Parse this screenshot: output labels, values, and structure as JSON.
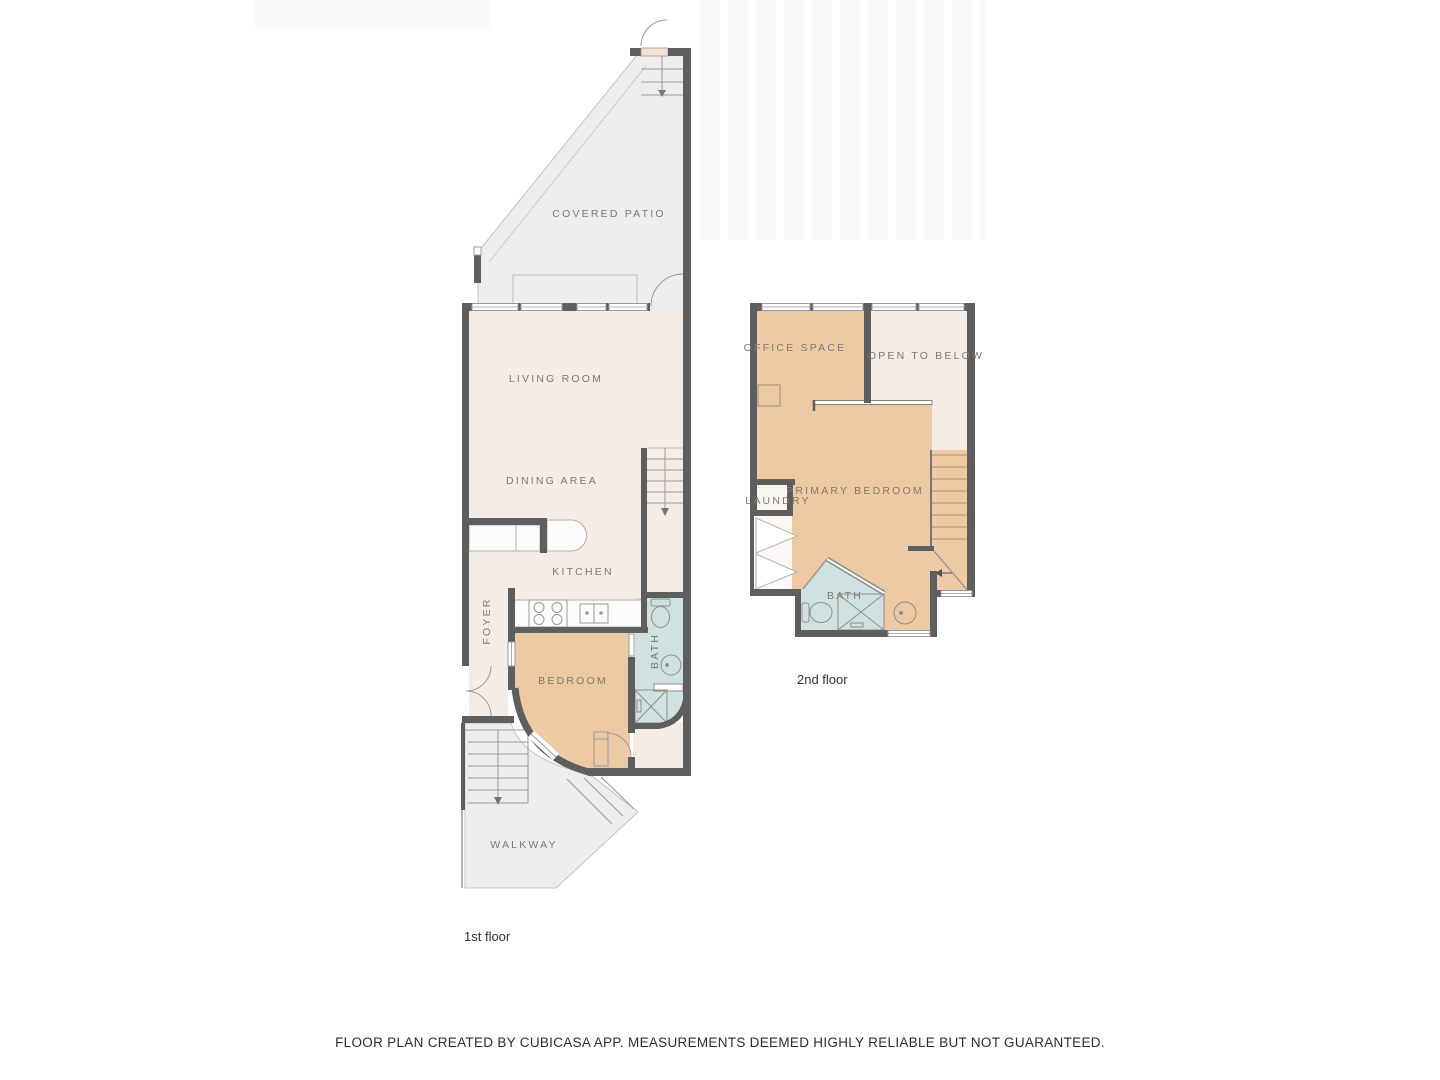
{
  "document": {
    "type": "floor-plan",
    "disclaimer": "FLOOR PLAN CREATED BY CUBICASA APP. MEASUREMENTS DEEMED HIGHLY RELIABLE BUT NOT GUARANTEED."
  },
  "floor1": {
    "caption": "1st floor",
    "rooms": {
      "covered_patio": "COVERED PATIO",
      "living_room": "LIVING ROOM",
      "dining_area": "DINING AREA",
      "kitchen": "KITCHEN",
      "foyer": "FOYER",
      "bedroom": "BEDROOM",
      "bath": "BATH",
      "walkway": "WALKWAY"
    }
  },
  "floor2": {
    "caption": "2nd floor",
    "rooms": {
      "office_space": "OFFICE SPACE",
      "open_to_below": "OPEN TO BELOW",
      "primary_bedroom": "PRIMARY BEDROOM",
      "laundry": "LAUNDRY",
      "bath": "BATH"
    }
  },
  "colors": {
    "wall": "#5e5e5e",
    "floor_cream": "#f5ece5",
    "floor_tan": "#edc9a4",
    "floor_blue": "#cfe1e1",
    "floor_gray": "#ededee",
    "label_text": "#7e7871",
    "caption_text": "#333333"
  }
}
